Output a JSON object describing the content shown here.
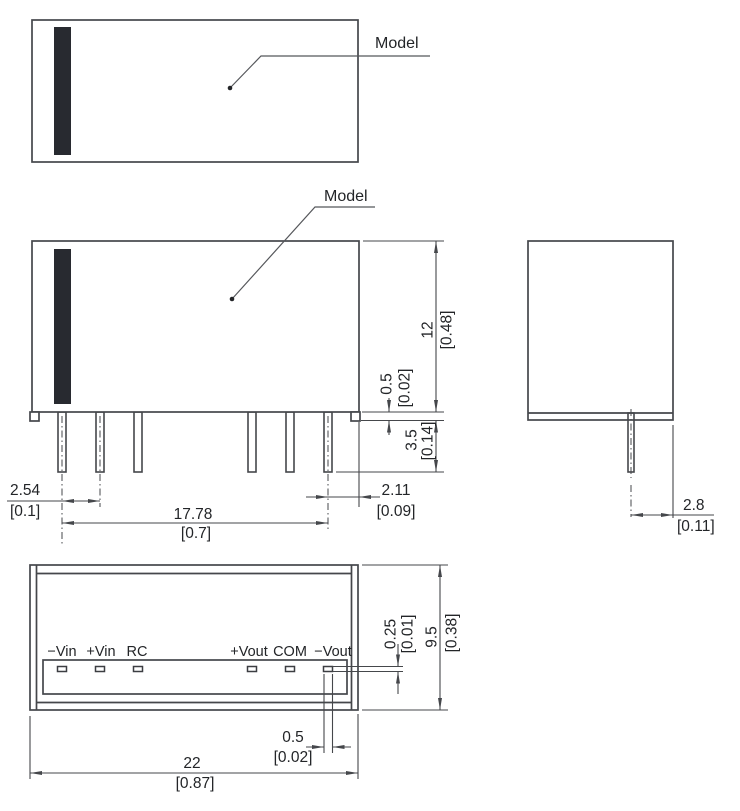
{
  "labels": {
    "top_view_model": "Model",
    "front_view_model": "Model"
  },
  "pins": {
    "labels": [
      "−Vin",
      "+Vin",
      "RC",
      "+Vout",
      "COM",
      "−Vout"
    ]
  },
  "dims": {
    "body_height": {
      "mm": "12",
      "in": "[0.48]"
    },
    "standoff_height": {
      "mm": "0.5",
      "in": "[0.02]"
    },
    "pin_length": {
      "mm": "3.5",
      "in": "[0.14]"
    },
    "pin_pitch": {
      "mm": "2.54",
      "in": "[0.1]"
    },
    "pin_row_span": {
      "mm": "17.78",
      "in": "[0.7]"
    },
    "pin_to_edge": {
      "mm": "2.11",
      "in": "[0.09]"
    },
    "side_pin_to_edge": {
      "mm": "2.8",
      "in": "[0.11]"
    },
    "pad_height": {
      "mm": "0.25",
      "in": "[0.01]"
    },
    "body_depth": {
      "mm": "9.5",
      "in": "[0.38]"
    },
    "pad_width": {
      "mm": "0.5",
      "in": "[0.02]"
    },
    "body_width": {
      "mm": "22",
      "in": "[0.87]"
    }
  },
  "colors": {
    "line": "#45474b",
    "stripe": "#282a30",
    "text": "#232528",
    "background": "#ffffff"
  }
}
